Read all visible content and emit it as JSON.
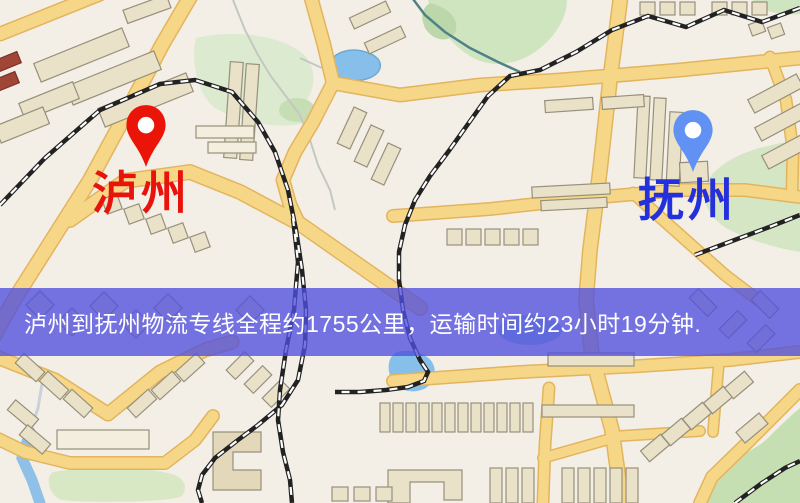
{
  "route_banner": {
    "text": "泸州到抚州物流专线全程约1755公里，运输时间约23小时19分钟.",
    "distance_text": "1755公里",
    "duration_text": "23小时19分钟"
  },
  "origin": {
    "label": "泸州"
  },
  "destination": {
    "label": "抚州"
  },
  "colors": {
    "origin_pin": "#ea1408",
    "origin_label": "#e8140c",
    "destination_pin": "#6191f2",
    "destination_label": "#2430dc",
    "banner_bg": "rgba(80,78,222,0.78)",
    "banner_text": "#ffffff",
    "map_background": "#f4efe6",
    "road_fill": "#f6d788",
    "road_casing": "#e3b45e",
    "railway": "#222222",
    "water": "#86bfe9",
    "park_green": "#cfe5c0",
    "building": "#eae2c8"
  }
}
